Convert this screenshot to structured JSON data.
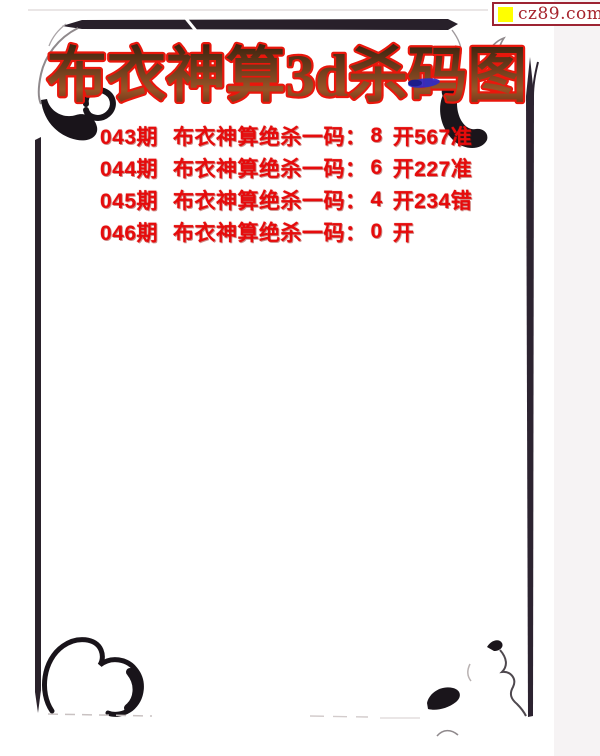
{
  "site_badge": {
    "text": "cz89.com",
    "icon": "yellow-square-icon"
  },
  "title": {
    "text": "布衣神算3d杀码图"
  },
  "predictions": {
    "rows": [
      {
        "period": "043期",
        "label": "布衣神算绝杀一码：",
        "kill_number": "8",
        "result": "开567准"
      },
      {
        "period": "044期",
        "label": "布衣神算绝杀一码：",
        "kill_number": "6",
        "result": "开227准"
      },
      {
        "period": "045期",
        "label": "布衣神算绝杀一码：",
        "kill_number": "4",
        "result": "开234错"
      },
      {
        "period": "046期",
        "label": "布衣神算绝杀一码：",
        "kill_number": "0",
        "result": "开"
      }
    ]
  },
  "colors": {
    "accent_red": "#e60b0c",
    "title_outline": "#e9170c",
    "title_fill": "#7c4520",
    "frame_ink": "#241c26",
    "badge_border_red": "#9d2433",
    "badge_yellow": "#ffff00",
    "ink_blue": "#2c2cc8"
  }
}
